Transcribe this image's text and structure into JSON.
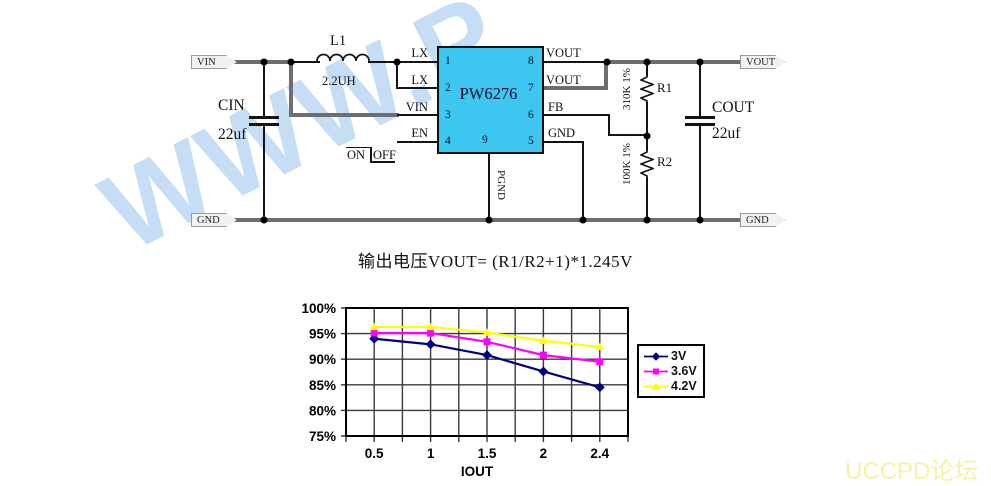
{
  "watermark_text": "WWW.P",
  "brand_text": "UCCPD论坛",
  "formula_text": "输出电压VOUT= (R1/R2+1)*1.245V",
  "colors": {
    "ic_fill": "#3CC6F0",
    "wire": "#141414",
    "rail": "#6E6E6E",
    "watermark": "#C6DDF6",
    "brand": "#F6F2A2"
  },
  "schematic": {
    "terminals": {
      "vin": "VIN",
      "gnd_left": "GND",
      "vout": "VOUT",
      "gnd_right": "GND"
    },
    "ic": {
      "part_number": "PW6276",
      "pin_numbers": {
        "p1": "1",
        "p2": "2",
        "p3": "3",
        "p4": "4",
        "p5": "5",
        "p6": "6",
        "p7": "7",
        "p8": "8",
        "p9": "9"
      }
    },
    "pin_labels": {
      "lx1": "LX",
      "lx2": "LX",
      "vin": "VIN",
      "en": "EN",
      "vout8": "VOUT",
      "vout7": "VOUT",
      "fb": "FB",
      "gnd": "GND",
      "pgnd": "PGND"
    },
    "components": {
      "inductor": {
        "ref": "L1",
        "value": "2.2UH"
      },
      "cin": {
        "ref": "CIN",
        "value": "22uf"
      },
      "cout": {
        "ref": "COUT",
        "value": "22uf"
      },
      "r1": {
        "ref": "R1",
        "value": "310K 1%"
      },
      "r2": {
        "ref": "R2",
        "value": "100K 1%"
      }
    },
    "enable_switch": {
      "on": "ON",
      "off": "OFF"
    }
  },
  "chart_data": {
    "type": "line",
    "title": "",
    "xlabel": "IOUT",
    "ylabel": "",
    "categories": [
      0.5,
      1,
      1.5,
      2,
      2.4
    ],
    "x_tick_labels": [
      "0.5",
      "1",
      "1.5",
      "2",
      "2.4"
    ],
    "y_tick_labels": [
      "100%",
      "95%",
      "90%",
      "85%",
      "80%",
      "75%"
    ],
    "ylim": [
      75,
      100
    ],
    "y_major_unit": 5,
    "grid": true,
    "legend_position": "right",
    "series": [
      {
        "name": "3V",
        "color": "#000080",
        "marker": "diamond",
        "values": [
          94.0,
          92.9,
          90.8,
          87.6,
          84.5
        ]
      },
      {
        "name": "3.6V",
        "color": "#FF00FF",
        "marker": "square",
        "values": [
          95.1,
          95.1,
          93.4,
          90.8,
          89.5
        ]
      },
      {
        "name": "4.2V",
        "color": "#FFFF00",
        "marker": "triangle",
        "values": [
          96.3,
          96.3,
          95.2,
          93.6,
          92.4
        ]
      }
    ]
  }
}
